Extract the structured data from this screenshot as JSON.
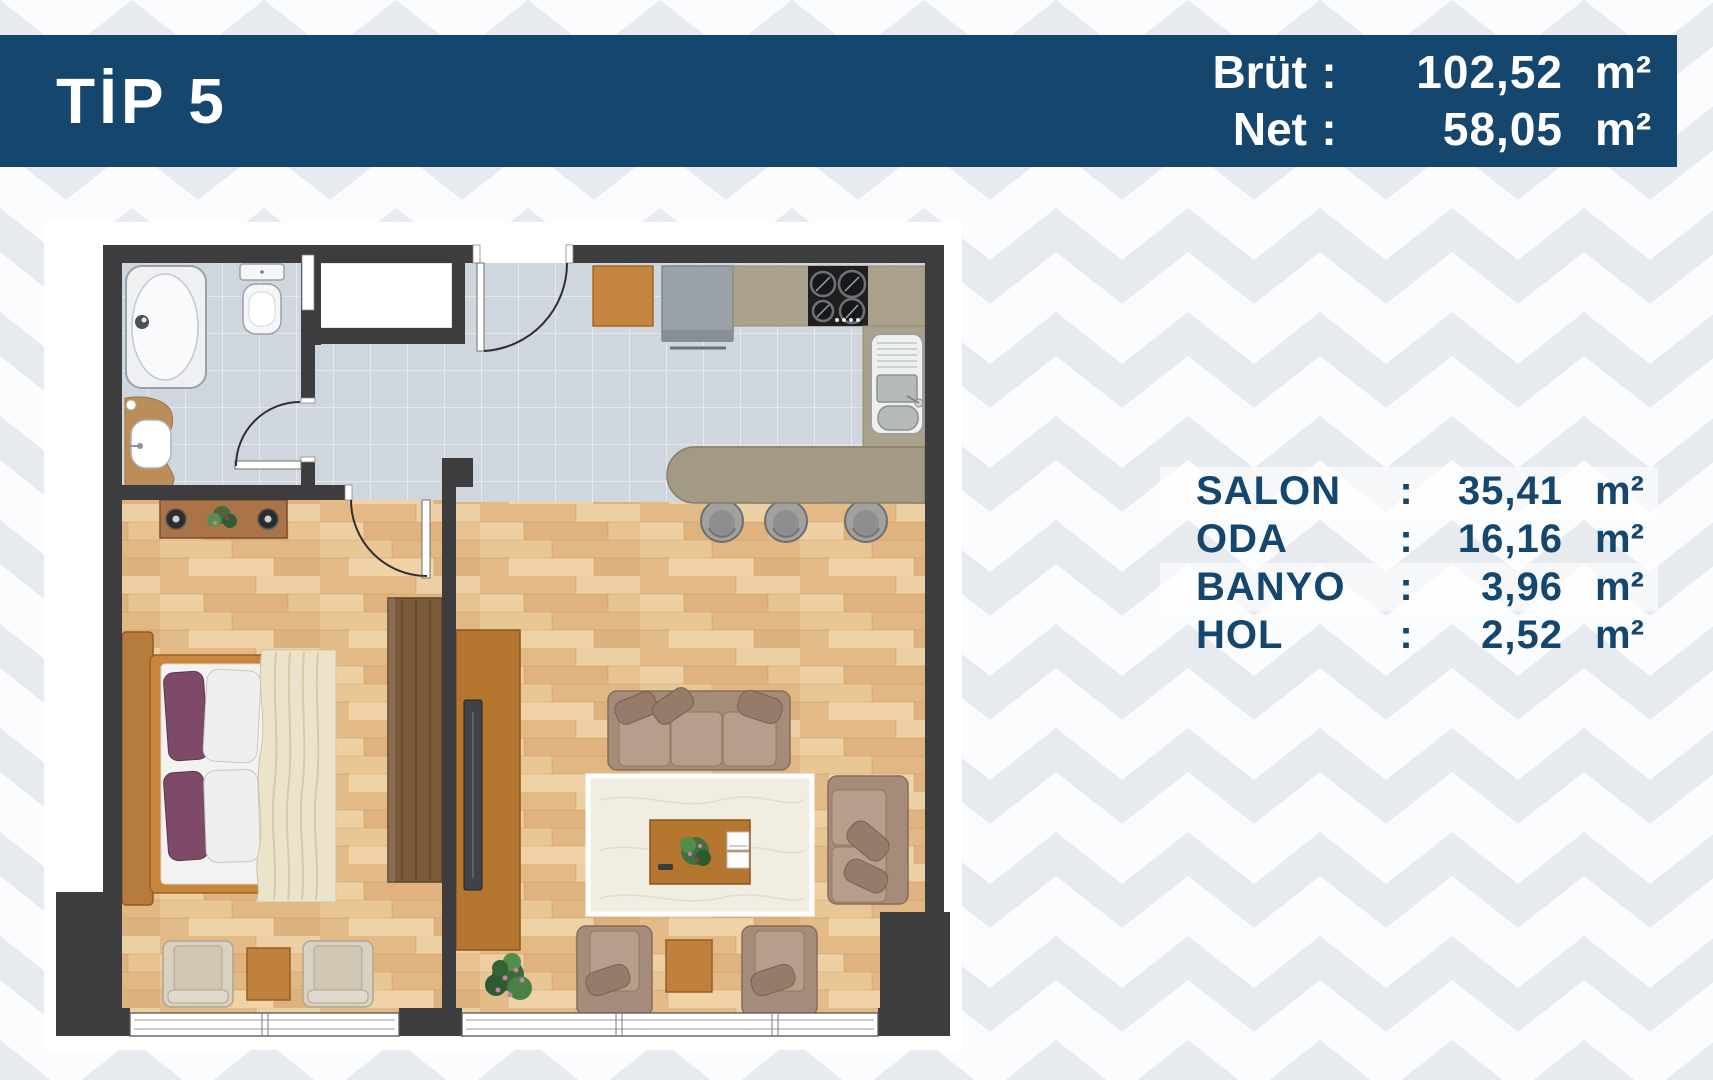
{
  "header": {
    "title": "TİP 5",
    "stats": [
      {
        "label": "Brüt",
        "sep": ":",
        "value": "102,52",
        "unit": "m²"
      },
      {
        "label": "Net",
        "sep": ":",
        "value": "58,05",
        "unit": "m²"
      }
    ]
  },
  "areas": [
    {
      "name": "SALON",
      "sep": ":",
      "value": "35,41",
      "unit": "m²"
    },
    {
      "name": "ODA",
      "sep": ":",
      "value": "16,16",
      "unit": "m²"
    },
    {
      "name": "BANYO",
      "sep": ":",
      "value": "3,96",
      "unit": "m²"
    },
    {
      "name": "HOL",
      "sep": ":",
      "value": "2,52",
      "unit": "m²"
    }
  ],
  "colors": {
    "banner_navy": "#15466d",
    "table_text": "#15466d",
    "chevron_gray": "#e7eaee",
    "wall_dark": "#3d3d3f",
    "tile_gray": "#cfd6dd",
    "wood_light": "#e7c091",
    "highlight_row": "rgba(255,255,255,0.62)"
  }
}
